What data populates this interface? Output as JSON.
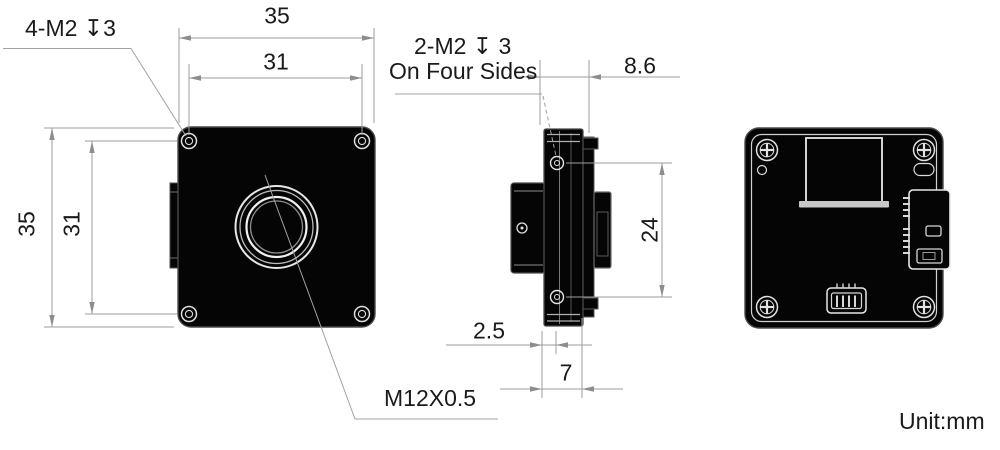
{
  "labels": {
    "front_mount_holes": "4-M2 ↧3",
    "side_mount_holes_line1": "2-M2 ↧ 3",
    "side_mount_holes_line2": "On Four Sides",
    "lens_thread": "M12X0.5"
  },
  "dimensions": {
    "front_width": "35",
    "front_hole_pitch_horizontal": "31",
    "front_height": "35",
    "front_hole_pitch_vertical": "31",
    "side_top_depth": "8.6",
    "side_hole_pitch": "24",
    "front_plate_thickness": "2.5",
    "body_depth": "7"
  },
  "notes": {
    "unit": "Unit:mm"
  },
  "colors": {
    "dimension_line": "#9e9e9e",
    "text": "#1a1a1a",
    "body_fill": "#050505",
    "detail_line": "#e0e0e0"
  }
}
